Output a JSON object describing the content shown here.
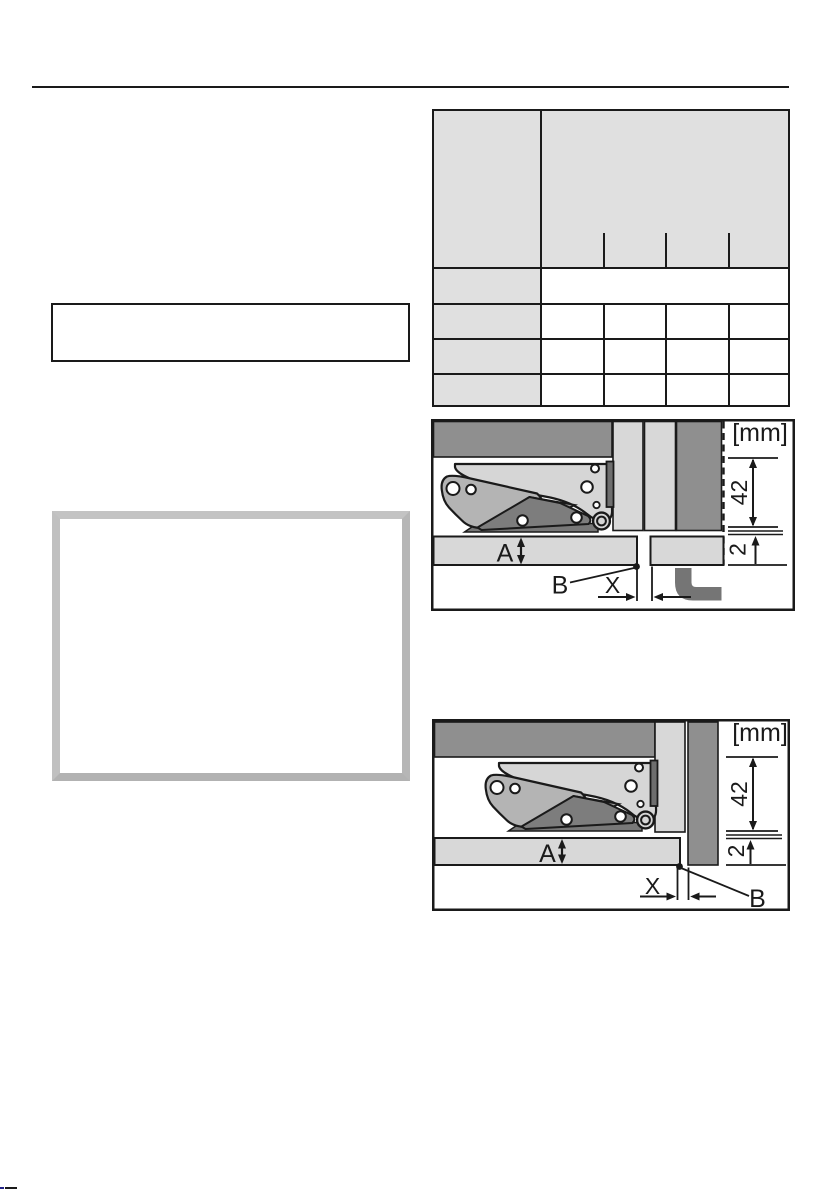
{
  "page": {
    "kind": "installation-manual-page",
    "visible_text_note": "page body text not rendered; only table grid, rule, boxes and two hinge diagrams visible"
  },
  "colors": {
    "line": "#1a1a1a",
    "table_header_fill": "#e0e0e0",
    "panel_dark_gray": "#8f8f8f",
    "panel_light_gray": "#d8d8d8",
    "hinge_plate": "#d6d6d6",
    "hinge_arm": "#b4b4b4",
    "hinge_lever": "#7d7d7d",
    "plinth_duct": "#757575",
    "frame_gray": "#bcbcbc",
    "corner_mark_blue": "#232387"
  },
  "table": {
    "columns": 5,
    "header_sub_columns": 4,
    "rows": [
      [
        "",
        "",
        "",
        "",
        ""
      ],
      [
        "",
        ""
      ],
      [
        "",
        "",
        "",
        "",
        ""
      ],
      [
        "",
        "",
        "",
        "",
        ""
      ],
      [
        "",
        "",
        "",
        "",
        ""
      ]
    ]
  },
  "diagram_top": {
    "unit": "[mm]",
    "dim_height": "42",
    "dim_gap": "2",
    "label_a": "A",
    "label_b": "B",
    "label_x": "X"
  },
  "diagram_bottom": {
    "unit": "[mm]",
    "dim_height": "42",
    "dim_gap": "2",
    "label_a": "A",
    "label_b": "B",
    "label_x": "X"
  }
}
